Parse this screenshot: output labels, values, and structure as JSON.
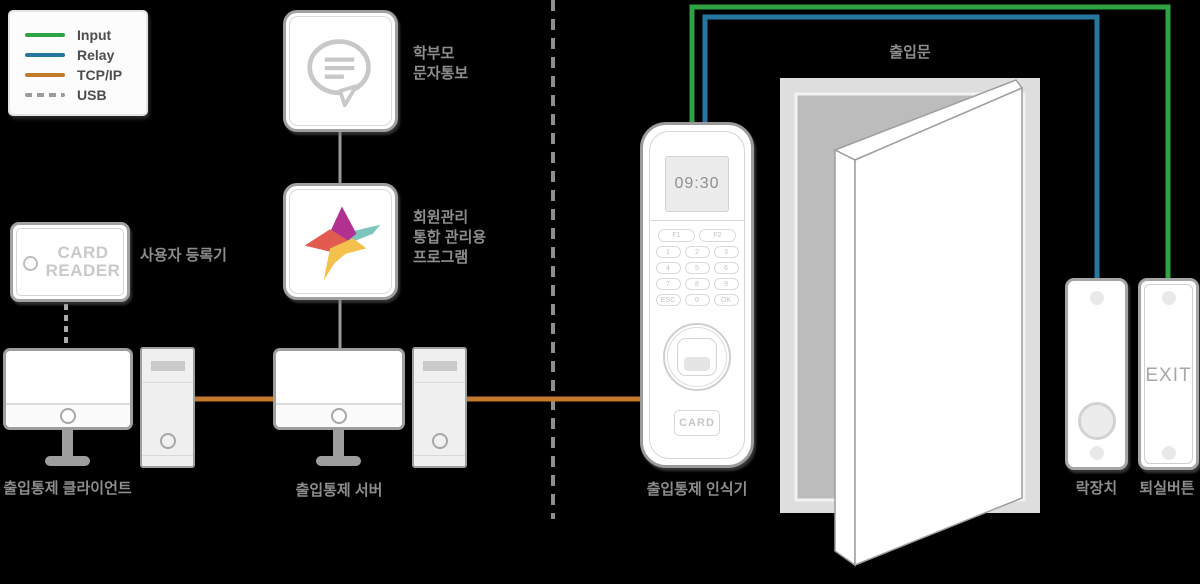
{
  "colors": {
    "input_green": "#2fa344",
    "relay_blue": "#26779f",
    "tcpip_orange": "#c47a2b",
    "usb_gray": "#9b9b9b",
    "connector_gray": "#9b9b9b",
    "label_gray": "#8d8d8d",
    "legend_text": "#4d4d4d",
    "background": "#000000"
  },
  "legend": {
    "items": [
      {
        "label": "Input",
        "style": "solid"
      },
      {
        "label": "Relay",
        "style": "solid"
      },
      {
        "label": "TCP/IP",
        "style": "solid"
      },
      {
        "label": "USB",
        "style": "dashed"
      }
    ]
  },
  "nodes": {
    "parent_sms": {
      "line1": "학부모",
      "line2": "문자통보"
    },
    "program": {
      "line1": "회원관리",
      "line2": "통합 관리용",
      "line3": "프로그램"
    },
    "card_reader": {
      "text_line1": "CARD",
      "text_line2": "READER",
      "label": "사용자 등록기"
    },
    "client": {
      "label": "출입통제 클라이언트"
    },
    "server": {
      "label": "출입통제 서버"
    },
    "reader": {
      "label": "출입통제 인식기",
      "display": "09:30",
      "card_button": "CARD",
      "keys": [
        "F1",
        "F2",
        "1",
        "2",
        "3",
        "4",
        "5",
        "6",
        "7",
        "8",
        "9",
        "ESC",
        "0",
        "OK"
      ]
    },
    "door": {
      "label": "출입문"
    },
    "lock": {
      "label": "락장치"
    },
    "exit": {
      "label": "퇴실버튼",
      "text": "EXIT"
    }
  }
}
